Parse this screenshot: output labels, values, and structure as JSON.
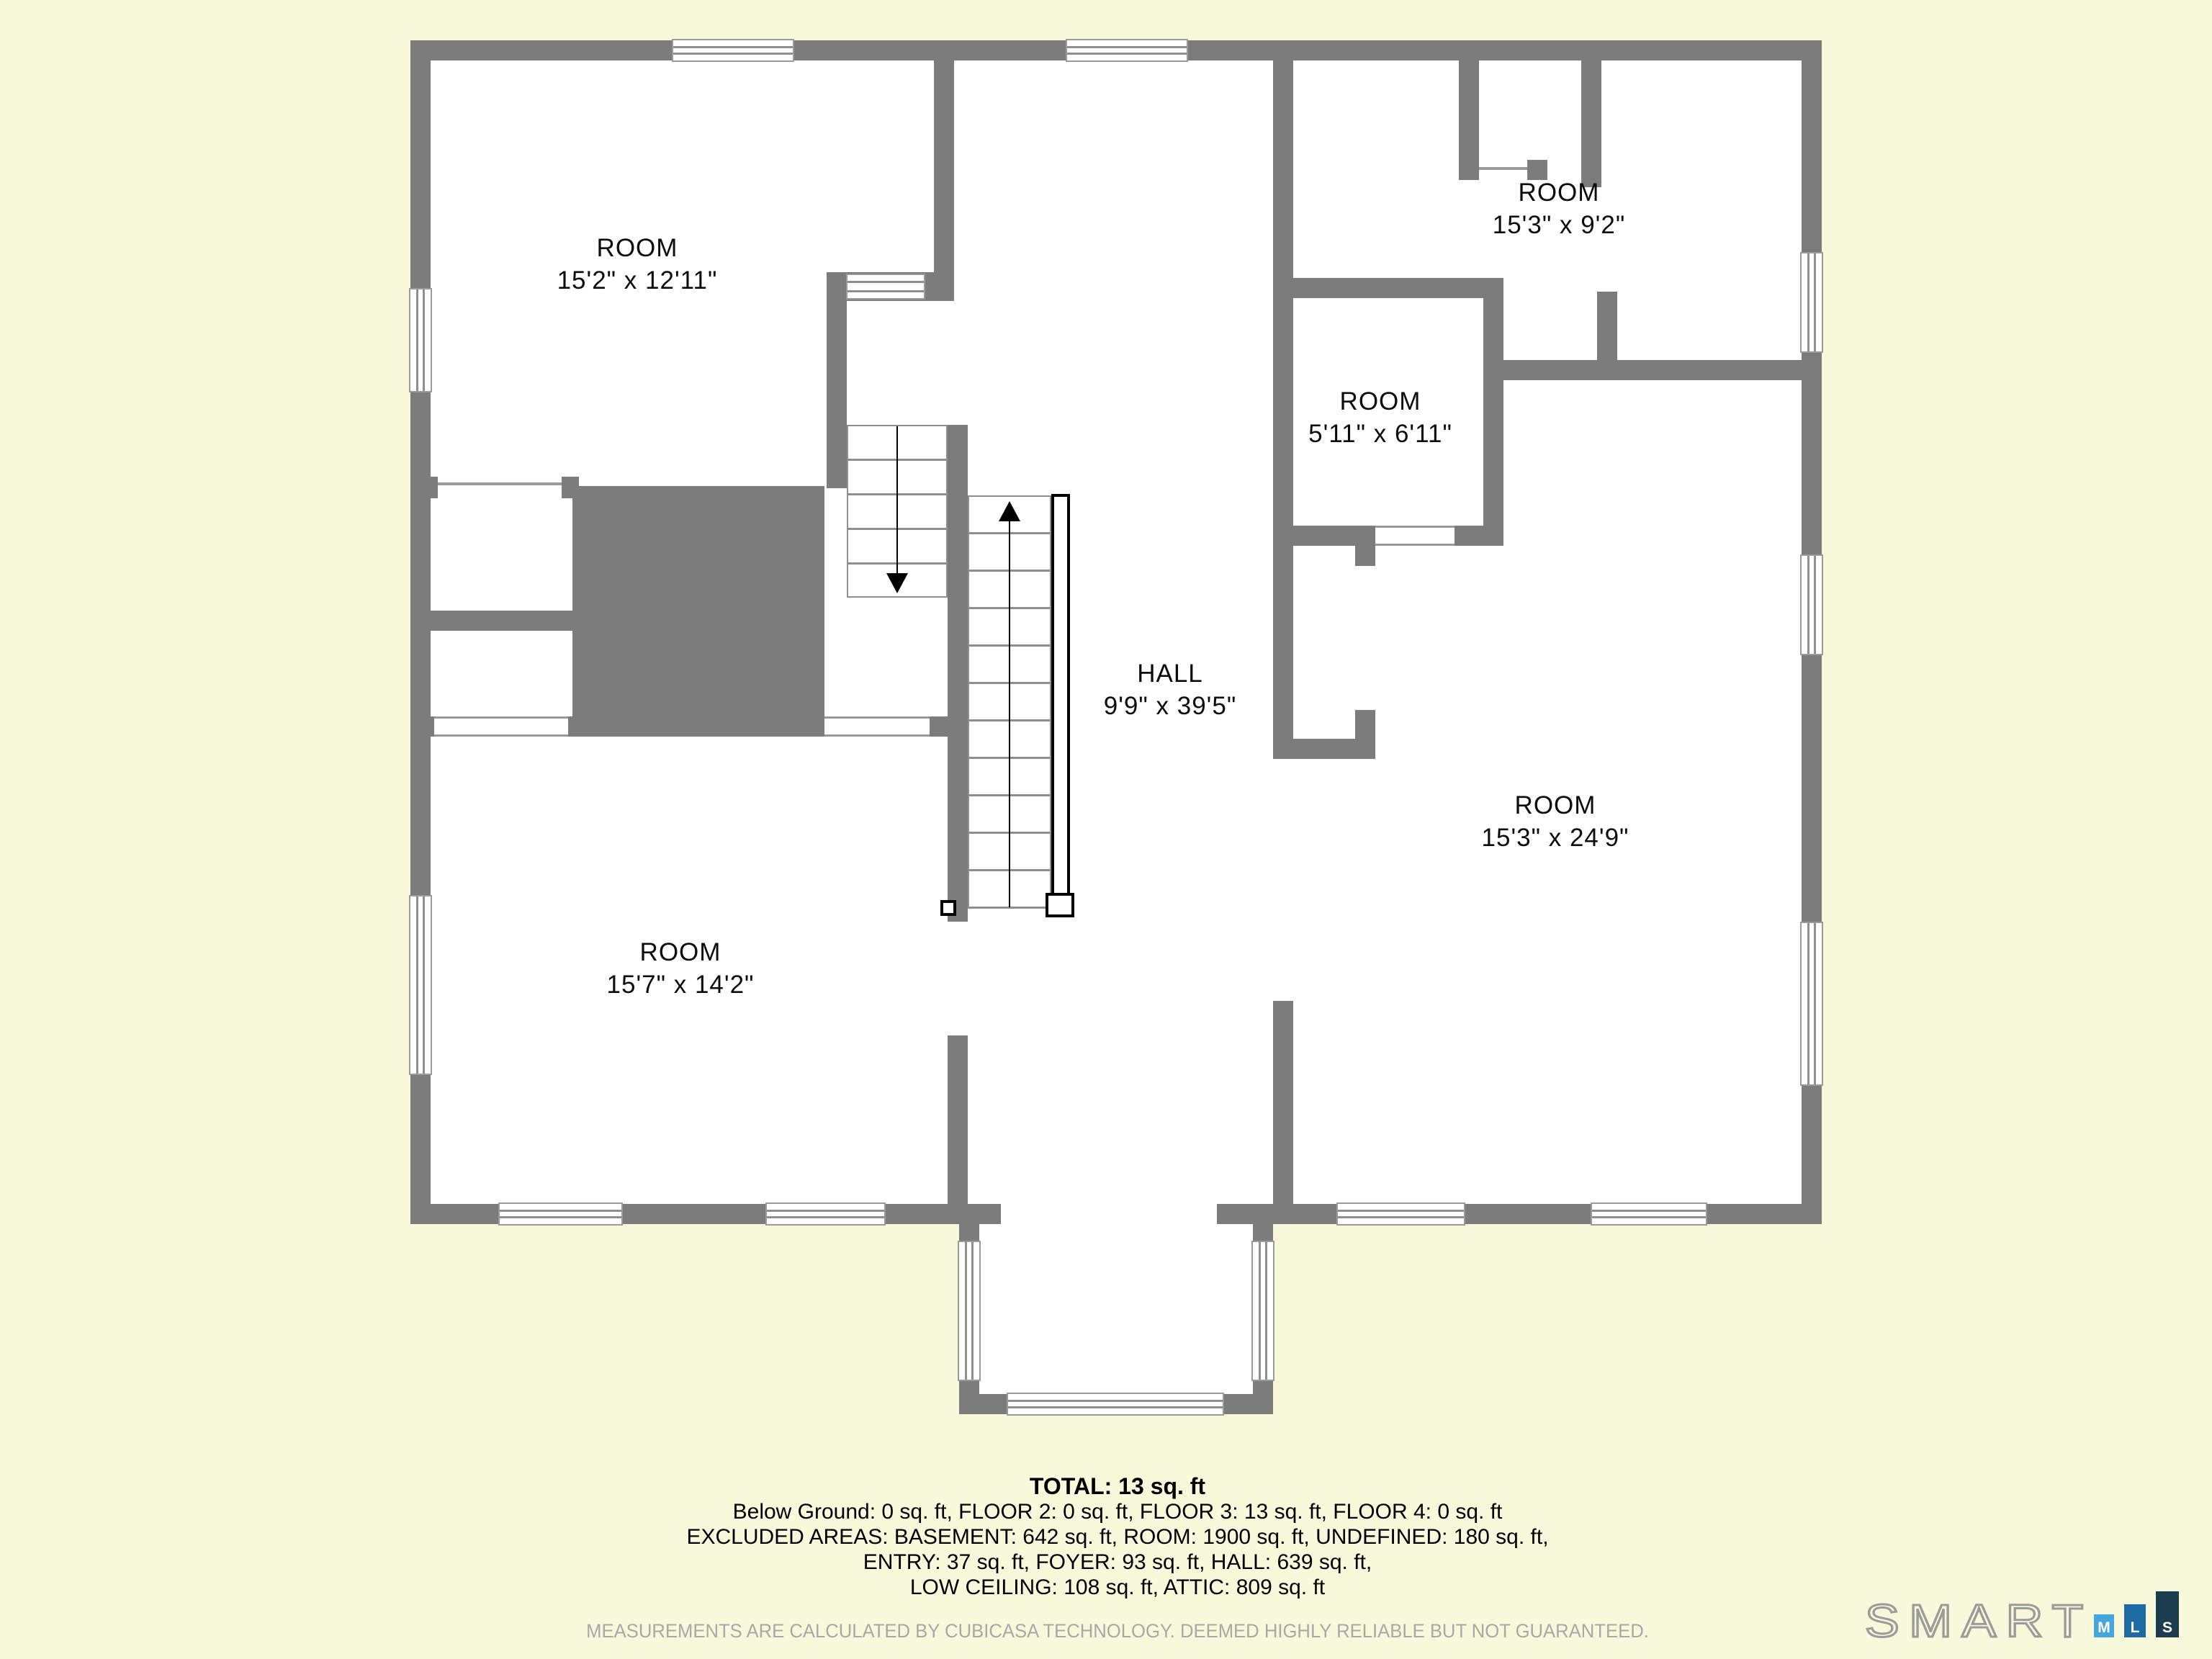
{
  "colors": {
    "background": "#f8f8da",
    "wall": "#7c7c7c",
    "floor": "#ffffff",
    "accent_line": "#8f8f8f",
    "disclaimer_text": "#a8a8a8",
    "logo_bar_m": "#47a7dd",
    "logo_bar_l": "#1d6ba3",
    "logo_bar_s": "#1c3d4f"
  },
  "rooms": [
    {
      "name": "ROOM",
      "dims": "15'2\" x 12'11\""
    },
    {
      "name": "ROOM",
      "dims": "15'3\" x 9'2\""
    },
    {
      "name": "ROOM",
      "dims": "5'11\" x 6'11\""
    },
    {
      "name": "HALL",
      "dims": "9'9\" x 39'5\""
    },
    {
      "name": "ROOM",
      "dims": "15'7\" x 14'2\""
    },
    {
      "name": "ROOM",
      "dims": "15'3\" x 24'9\""
    }
  ],
  "summary": {
    "title": "TOTAL: 13 sq. ft",
    "lines": [
      "Below Ground: 0 sq. ft, FLOOR 2: 0 sq. ft, FLOOR 3: 13 sq. ft, FLOOR 4: 0 sq. ft",
      "EXCLUDED AREAS: BASEMENT: 642 sq. ft, ROOM: 1900 sq. ft, UNDEFINED: 180 sq. ft,",
      "ENTRY: 37 sq. ft, FOYER: 93 sq. ft, HALL: 639 sq. ft,",
      "LOW CEILING: 108 sq. ft, ATTIC: 809 sq. ft"
    ]
  },
  "disclaimer": "MEASUREMENTS ARE CALCULATED BY CUBICASA TECHNOLOGY. DEEMED HIGHLY RELIABLE BUT NOT GUARANTEED.",
  "logo": {
    "brand": "SMART",
    "bars": [
      {
        "letter": "M",
        "color": "#47a7dd"
      },
      {
        "letter": "L",
        "color": "#1d6ba3"
      },
      {
        "letter": "S",
        "color": "#1c3d4f"
      }
    ]
  }
}
